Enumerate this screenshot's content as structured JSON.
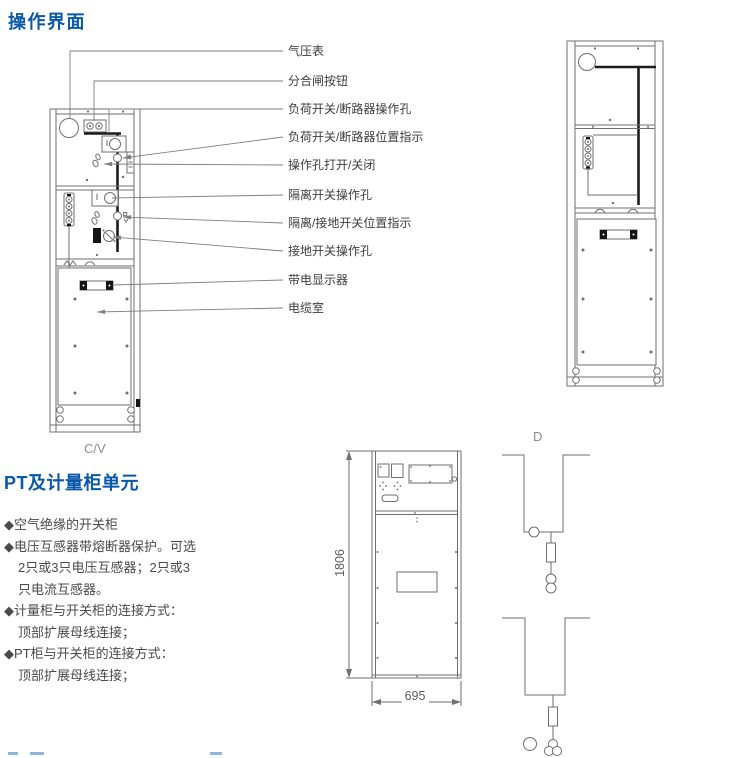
{
  "colors": {
    "heading_blue": "#0a58a8",
    "body_text": "#4a4a4a",
    "callout_text": "#3d3d3d",
    "diagram_line": "#6f6f6f",
    "diagram_bar": "#1c1c1c",
    "figure_label_gray": "#8c8c8c"
  },
  "sections": {
    "operation": {
      "title": "操作界面",
      "callouts": [
        "气压表",
        "分合闸按钮",
        "负荷开关/断路器操作孔",
        "负荷开关/断路器位置指示",
        "操作孔打开/关闭",
        "隔离开关操作孔",
        "隔离/接地开关位置指示",
        "接地开关操作孔",
        "带电显示器",
        "电缆室"
      ],
      "left_figure_label": "C/V"
    },
    "pt_unit": {
      "title": "PT及计量柜单元",
      "bullets": [
        "◆空气绝缘的开关柜",
        "◆电压互感器带熔断器保护。可选",
        "2只或3只电压互感器；2只或3",
        "只电流互感器。",
        "◆计量柜与开关柜的连接方式：",
        "顶部扩展母线连接；",
        "◆PT柜与开关柜的连接方式：",
        "顶部扩展母线连接；"
      ],
      "figure": {
        "label": "D",
        "dim_height": "1806",
        "dim_width": "695"
      }
    }
  }
}
